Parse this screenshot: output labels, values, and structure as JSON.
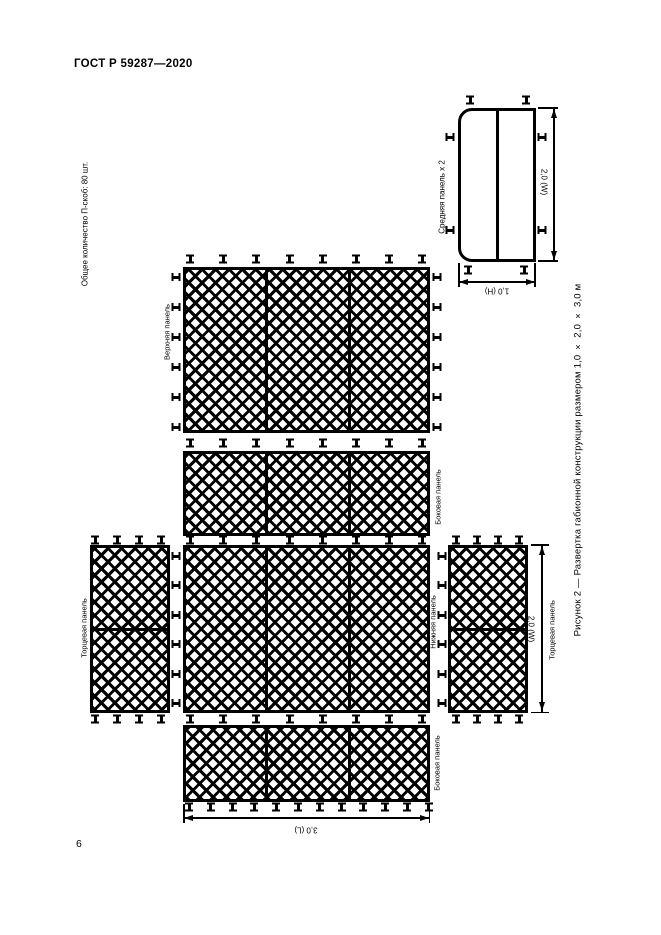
{
  "page": {
    "standard_number": "ГОСТ Р 59287—2020",
    "page_number": "6"
  },
  "figure": {
    "staple_note": "Общее количество П-скоб: 80 шт.",
    "caption": "Рисунок 2 — Развертка габионной конструкции размером 1,0 × 2,0 × 3,0 м",
    "panels": {
      "top": "Верхняя панель",
      "side_upper": "Боковая панель",
      "side_lower": "Боковая панель",
      "bottom": "Нижняя панель",
      "end_left": "Торцевая панель",
      "end_right": "Торцевая панель",
      "middle": "Средняя панель х 2"
    },
    "dimensions": {
      "length": "3,0 (L)",
      "width": "2,0 (W)",
      "middle_panel_width": "2,0 (W)",
      "middle_panel_height": "1,0 (H)"
    },
    "colors": {
      "line": "#000000",
      "background": "#ffffff"
    }
  }
}
